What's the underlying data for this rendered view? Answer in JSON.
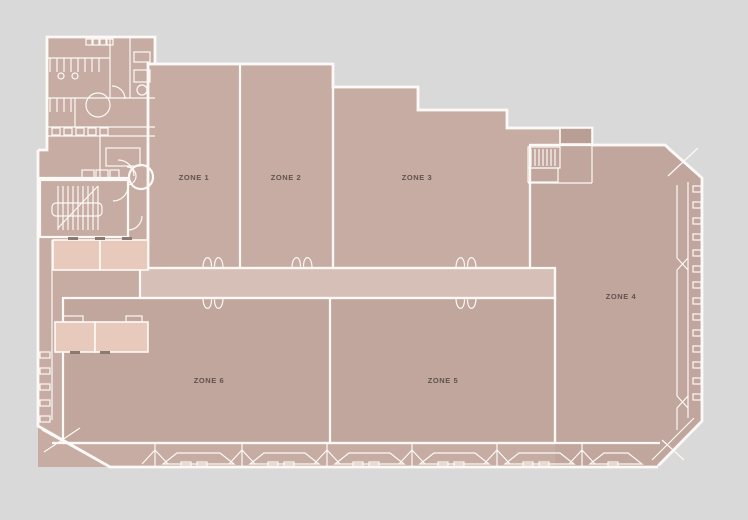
{
  "meta": {
    "type": "floor-plan"
  },
  "zones": [
    {
      "id": "zone-1",
      "label": "ZONE 1"
    },
    {
      "id": "zone-2",
      "label": "ZONE 2"
    },
    {
      "id": "zone-3",
      "label": "ZONE 3"
    },
    {
      "id": "zone-4",
      "label": "ZONE 4"
    },
    {
      "id": "zone-5",
      "label": "ZONE 5"
    },
    {
      "id": "zone-6",
      "label": "ZONE 6"
    }
  ],
  "colors": {
    "background": "#d9d9d9",
    "floor": "#c6aca3",
    "floor_dark": "#c1a69d",
    "corridor": "#d6bfb6",
    "room_light": "#e8cabc",
    "room_dark": "#b99e96",
    "wall": "#fdf9f6",
    "label_text": "#5f544e",
    "door_mark": "#8a7a72"
  },
  "icons": {
    "double-door-icon": "paired swing-arc petals",
    "stairs-icon": "parallel tread lines",
    "window-mullion": "small facade rectangles",
    "facade-brace": "diagonal X cross lines"
  }
}
